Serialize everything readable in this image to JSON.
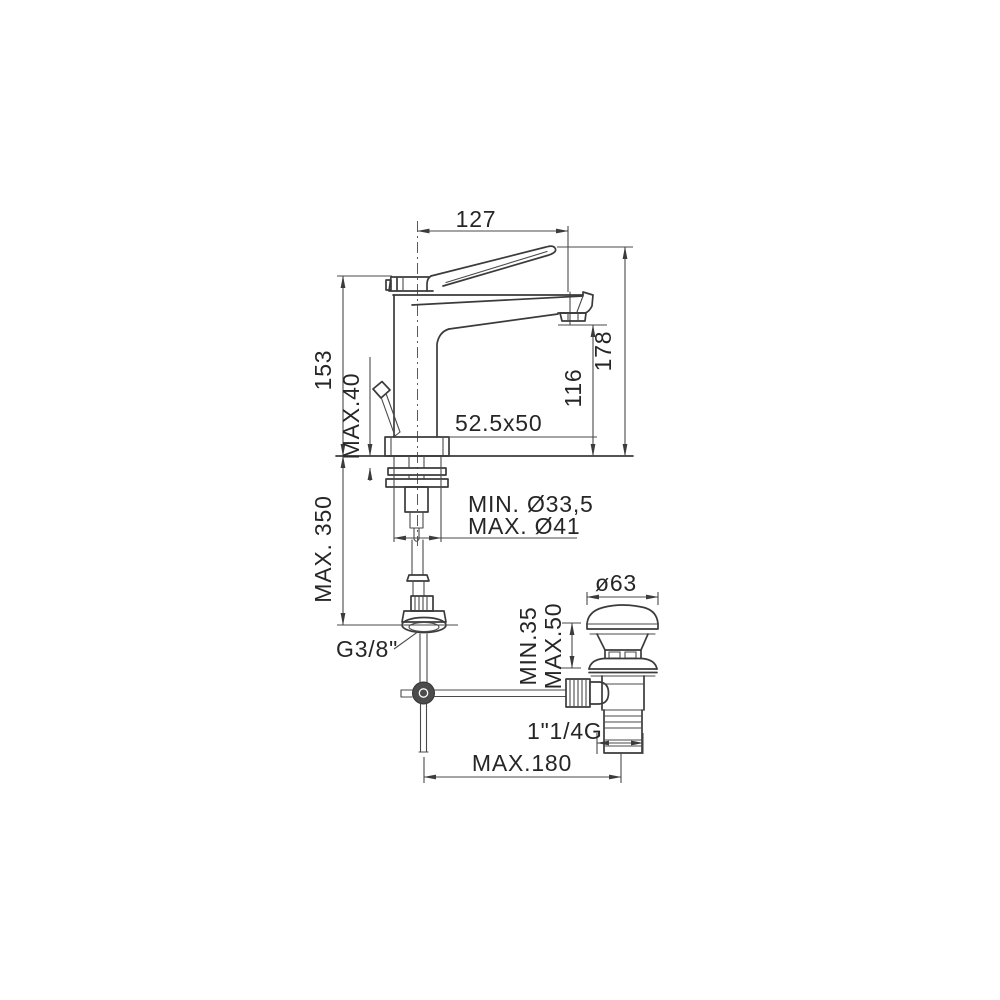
{
  "diagram": {
    "type": "technical-drawing",
    "subject": "Single-lever basin mixer tap with pop-up waste — dimensioned side elevation",
    "background_color": "#ffffff",
    "line_color": "#3b3b3b",
    "text_color": "#262626",
    "dimensions": {
      "spout_reach_top": "127",
      "body_height_left": "153",
      "deck_thickness": "MAX.40",
      "overall_height": "178",
      "spout_outlet_height": "116",
      "base_footprint": "52.5x50",
      "hole_diameter_min": "MIN. Ø33,5",
      "hole_diameter_max": "MAX. Ø41",
      "hose_length": "MAX. 350",
      "supply_thread": "G3/8\"",
      "waste_cap_diameter": "ø63",
      "basin_thickness_min": "MIN.35",
      "basin_thickness_max": "MAX.50",
      "waste_thread": "1\"1/4G",
      "rod_reach": "MAX.180"
    }
  }
}
